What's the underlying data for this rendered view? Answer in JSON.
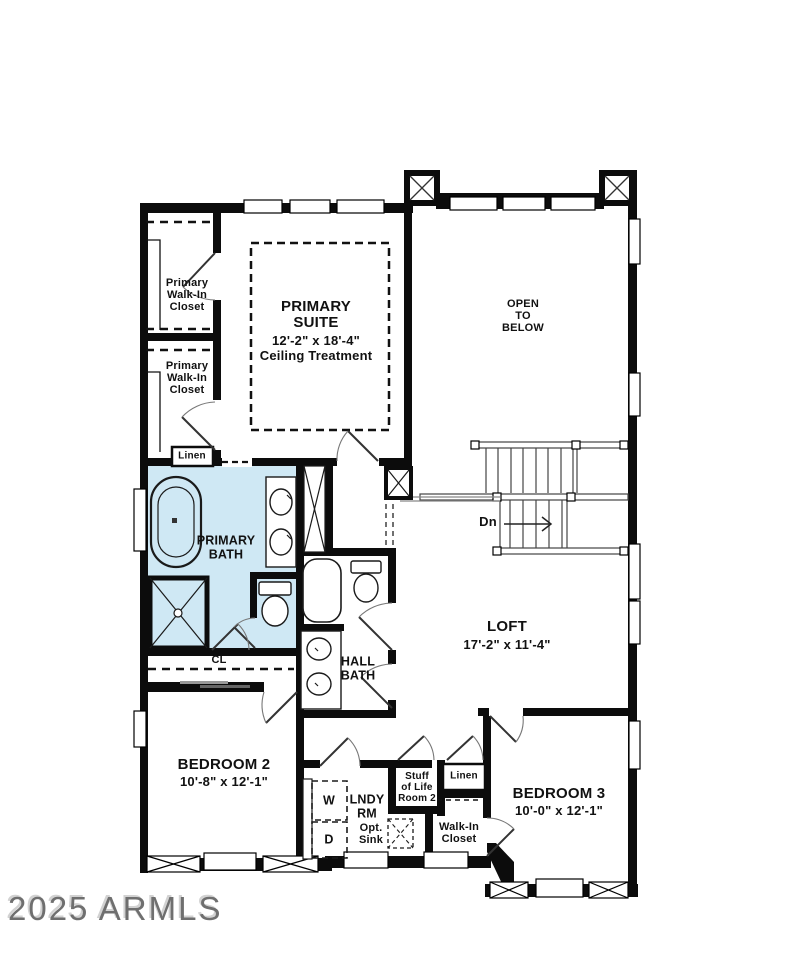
{
  "watermark": {
    "text": "2025 ARMLS"
  },
  "colors": {
    "bath_fill": "#cfe8f4",
    "wall": "#0c0c0c",
    "line": "#333333",
    "watermark": "#6f6f6f"
  },
  "labels": {
    "primary_walkin_closet_1": "Primary\nWalk-In\nCloset",
    "primary_walkin_closet_2": "Primary\nWalk-In\nCloset",
    "linen_upper": "Linen",
    "primary_suite_name": "PRIMARY\nSUITE",
    "primary_suite_dims": "12'-2\" x 18'-4\"",
    "primary_suite_note": "Ceiling Treatment",
    "open_to_below": "OPEN\nTO\nBELOW",
    "stairs_down": "Dn",
    "primary_bath": "PRIMARY\nBATH",
    "hall_bath": "HALL\nBATH",
    "loft_name": "LOFT",
    "loft_dims": "17'-2\" x 11'-4\"",
    "closet_cl": "CL",
    "bedroom2_name": "BEDROOM 2",
    "bedroom2_dims": "10'-8\" x 12'-1\"",
    "laundry_name": "LNDY\nRM",
    "laundry_opt_sink": "Opt.\nSink",
    "washer": "W",
    "dryer": "D",
    "stuff_of_life": "Stuff\nof Life\nRoom 2",
    "linen_lower": "Linen",
    "walkin_closet": "Walk-In\nCloset",
    "bedroom3_name": "BEDROOM 3",
    "bedroom3_dims": "10'-0\" x 12'-1\""
  }
}
